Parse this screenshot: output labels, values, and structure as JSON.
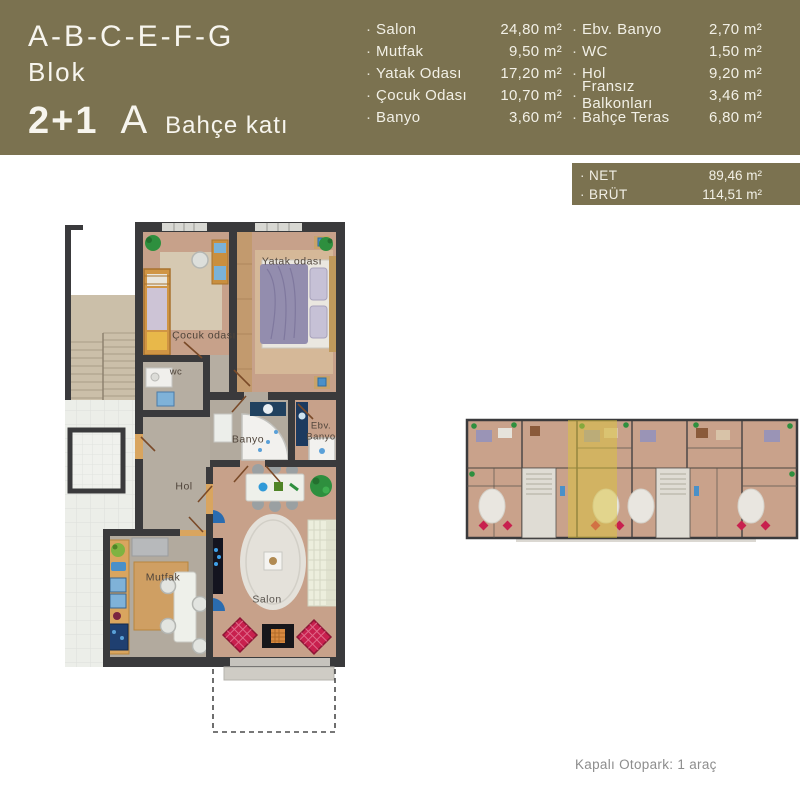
{
  "header": {
    "block_title": "A-B-C-E-F-G",
    "block_subtitle": "Blok",
    "unit_type": "2+1",
    "unit_letter": "A",
    "floor_name": "Bahçe katı",
    "bg_color": "#7b7250"
  },
  "symbols": {
    "bullet": "·"
  },
  "room_list": {
    "col1": [
      {
        "label": "Salon",
        "value": "24,80 m²"
      },
      {
        "label": "Mutfak",
        "value": "9,50 m²"
      },
      {
        "label": "Yatak Odası",
        "value": "17,20 m²"
      },
      {
        "label": "Çocuk Odası",
        "value": "10,70 m²"
      },
      {
        "label": "Banyo",
        "value": "3,60 m²"
      }
    ],
    "col2": [
      {
        "label": "Ebv. Banyo",
        "value": "2,70 m²"
      },
      {
        "label": "WC",
        "value": "1,50 m²"
      },
      {
        "label": "Hol",
        "value": "9,20 m²"
      },
      {
        "label": "Fransız Balkonları",
        "value": "3,46 m²"
      },
      {
        "label": "Bahçe Teras",
        "value": "6,80 m²"
      }
    ]
  },
  "totals": [
    {
      "label": "NET",
      "value": "89,46 m²"
    },
    {
      "label": "BRÜT",
      "value": "114,51 m²"
    }
  ],
  "floor_plan": {
    "labels": {
      "yatak_odasi": "Yatak odası",
      "cocuk_odasi": "Çocuk odası",
      "wc": "wc",
      "banyo": "Banyo",
      "ebv_line1": "Ebv.",
      "ebv_line2": "Banyo",
      "hol": "Hol",
      "mutfak": "Mutfak",
      "salon": "Salon"
    },
    "wall_color": "#3a3a3c",
    "floor_tan": "#c7a18a",
    "floor_gray": "#b2aa9e",
    "highlight_yellow": "#dcc33a"
  },
  "footer": {
    "parking": "Kapalı Otopark: 1 araç"
  }
}
